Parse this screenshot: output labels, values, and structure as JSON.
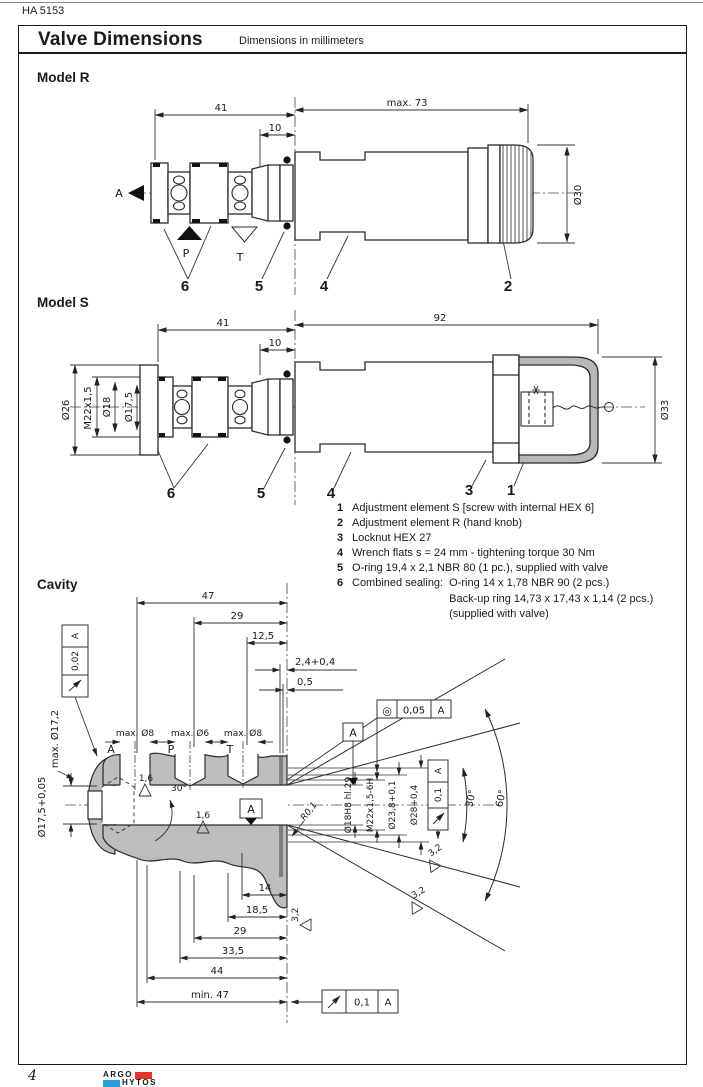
{
  "page": {
    "code": "HA 5153",
    "number": "4"
  },
  "titlebar": {
    "title": "Valve Dimensions",
    "subtitle": "Dimensions in millimeters"
  },
  "logo": {
    "top": "ARGO",
    "bottom": "HYTOS",
    "red": "#e63329",
    "blue": "#2a9fd8"
  },
  "model_r": {
    "heading": "Model R",
    "dim_41": "41",
    "dim_10": "10",
    "dim_max73": "max. 73",
    "dim_d30": "Ø30",
    "port_a": "A",
    "port_p": "P",
    "port_t": "T",
    "callout_6": "6",
    "callout_5": "5",
    "callout_4": "4",
    "callout_2": "2"
  },
  "model_s": {
    "heading": "Model S",
    "dim_41": "41",
    "dim_10": "10",
    "dim_92": "92",
    "dim_d26": "Ø26",
    "dim_m22": "M22x1,5",
    "dim_d18": "Ø18",
    "dim_d175": "Ø17,5",
    "dim_d33": "Ø33",
    "callout_6": "6",
    "callout_5": "5",
    "callout_4": "4",
    "callout_3": "3",
    "callout_1": "1"
  },
  "legend": {
    "items": [
      {
        "num": "1",
        "text": "Adjustment element S [screw with internal HEX 6]"
      },
      {
        "num": "2",
        "text": "Adjustment element R (hand knob)"
      },
      {
        "num": "3",
        "text": "Locknut HEX 27"
      },
      {
        "num": "4",
        "text": "Wrench flats s = 24 mm - tightening torque 30 Nm"
      },
      {
        "num": "5",
        "text": "O-ring 19,4 x 2,1 NBR 80 (1 pc.), supplied with valve"
      },
      {
        "num": "6",
        "text": "Combined sealing:",
        "text2": "O-ring 14 x 1,78 NBR 90 (2 pcs.)",
        "text3": "Back-up ring 14,73 x 17,43 x 1,14 (2 pcs.)",
        "text4": "(supplied with valve)"
      }
    ]
  },
  "cavity": {
    "heading": "Cavity",
    "dim_47": "47",
    "dim_29": "29",
    "dim_125": "12,5",
    "dim_24": "2,4+0,4",
    "dim_05": "0,5",
    "frame_left": {
      "value": "0,02",
      "datum": "A"
    },
    "dim_max172": "max. Ø17,2",
    "dim_d175": "Ø17,5+0,05",
    "port_a": "A",
    "port_p": "P",
    "port_t": "T",
    "dim_max8": "max. Ø8",
    "dim_max6": "max. Ø6",
    "rough_16": "1,6",
    "rough_32": "3,2",
    "chamfer_30": "30°",
    "angle_30": "30°",
    "angle_60": "60°",
    "radius": "R0,1",
    "datum": "A",
    "bore": {
      "d18": "Ø18H8 hl.29",
      "m22": "M22x1,5-6H",
      "d238": "Ø23,8+0,1",
      "d28": "Ø28+0,4"
    },
    "frame_conc": {
      "symbol": "◎",
      "value": "0,05",
      "datum": "A"
    },
    "frame_runout_r": {
      "value": "0,1",
      "datum": "A"
    },
    "frame_runout_b": {
      "value": "0,1",
      "datum": "A"
    },
    "dim_14": "14",
    "dim_185": "18,5",
    "dim_b29": "29",
    "dim_335": "33,5",
    "dim_44": "44",
    "dim_min47": "min. 47"
  }
}
